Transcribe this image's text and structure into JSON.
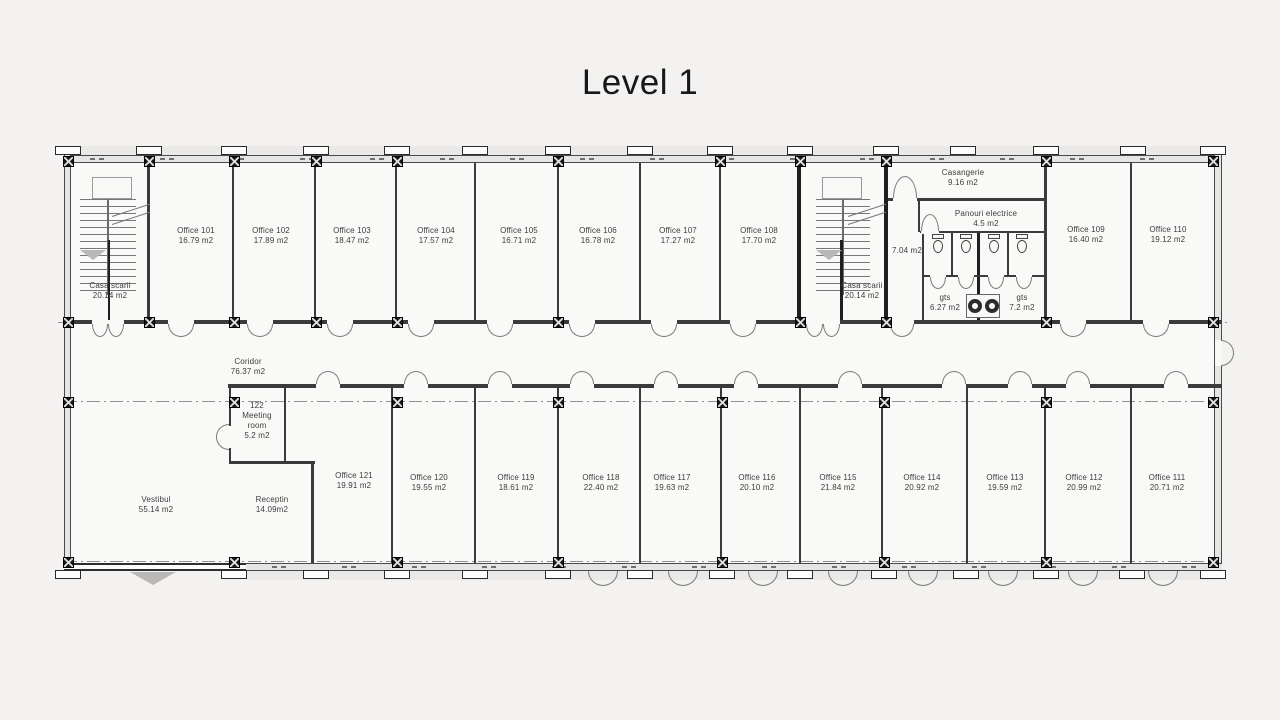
{
  "title": "Level 1",
  "colors": {
    "wall": "#2e2e2e",
    "thin_line": "#7a7a7a",
    "window_band": "#e6e5e3",
    "background": "#f3f2f0",
    "paper": "#f9f9f7",
    "label_text": "#3d3d3d"
  },
  "rooms": {
    "casa_scarii_1": {
      "name": "Casa scarii",
      "area": "20.14 m2"
    },
    "office_101": {
      "name": "Office 101",
      "area": "16.79 m2"
    },
    "office_102": {
      "name": "Office 102",
      "area": "17.89 m2"
    },
    "office_103": {
      "name": "Office 103",
      "area": "18.47 m2"
    },
    "office_104": {
      "name": "Office 104",
      "area": "17.57 m2"
    },
    "office_105": {
      "name": "Office 105",
      "area": "16.71 m2"
    },
    "office_106": {
      "name": "Office 106",
      "area": "16.78 m2"
    },
    "office_107": {
      "name": "Office 107",
      "area": "17.27 m2"
    },
    "office_108": {
      "name": "Office 108",
      "area": "17.70 m2"
    },
    "casa_scarii_2": {
      "name": "Casa scarii",
      "area": "20.14 m2"
    },
    "casangerie": {
      "name": "Casangerie",
      "area": "9.16 m2"
    },
    "panouri_electrice": {
      "name": "Panouri electrice",
      "area": "4.5 m2"
    },
    "hol_tech": {
      "area": "7.04 m2"
    },
    "gts_left": {
      "name": "gts",
      "area": "6.27 m2"
    },
    "gts_right": {
      "name": "gts",
      "area": "7.2 m2"
    },
    "office_109": {
      "name": "Office 109",
      "area": "16.40 m2"
    },
    "office_110": {
      "name": "Office 110",
      "area": "19.12 m2"
    },
    "coridor": {
      "name": "Coridor",
      "area": "76.37 m2"
    },
    "meeting_122": {
      "line1": "122",
      "line2": "Meeting",
      "line3": "room",
      "area": "5.2 m2"
    },
    "vestibul": {
      "name": "Vestibul",
      "area": "55.14 m2"
    },
    "receptin": {
      "name": "Receptin",
      "area": "14.09m2"
    },
    "office_121": {
      "name": "Office 121",
      "area": "19.91 m2"
    },
    "office_120": {
      "name": "Office 120",
      "area": "19.55 m2"
    },
    "office_119": {
      "name": "Office 119",
      "area": "18.61 m2"
    },
    "office_118": {
      "name": "Office 118",
      "area": "22.40 m2"
    },
    "office_117": {
      "name": "Office 117",
      "area": "19.63 m2"
    },
    "office_116": {
      "name": "Office 116",
      "area": "20.10 m2"
    },
    "office_115": {
      "name": "Office 115",
      "area": "21.84 m2"
    },
    "office_114": {
      "name": "Office 114",
      "area": "20.92 m2"
    },
    "office_113": {
      "name": "Office 113",
      "area": "19.59 m2"
    },
    "office_112": {
      "name": "Office 112",
      "area": "20.99 m2"
    },
    "office_111": {
      "name": "Office 111",
      "area": "20.71 m2"
    }
  }
}
